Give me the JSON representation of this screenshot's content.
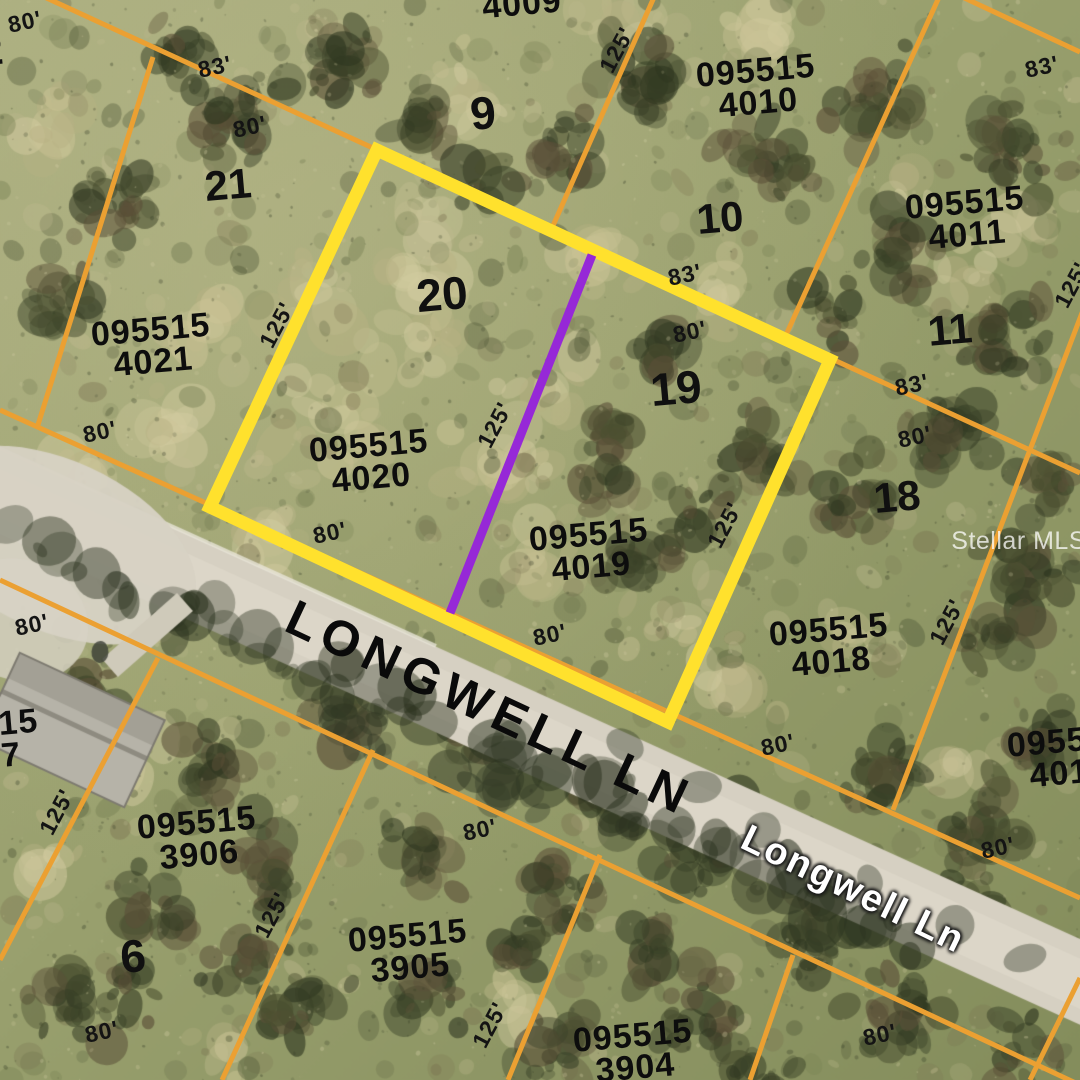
{
  "watermark": "Stellar MLS",
  "colors": {
    "highlight_yellow": "#FFE12D",
    "boundary_orange": "#EBA032",
    "division_purple": "#9628D7"
  },
  "roads": [
    {
      "name": "LONGWELL LN",
      "x": 490,
      "y": 708,
      "rotate": 25,
      "style": "road-black"
    },
    {
      "name": "Longwell Ln",
      "x": 853,
      "y": 890,
      "rotate": 26,
      "style": "road-white"
    }
  ],
  "highlighted_parcel": {
    "corners": [
      [
        377,
        150
      ],
      [
        830,
        360
      ],
      [
        668,
        722
      ],
      [
        210,
        507
      ]
    ],
    "stroke_width": 13,
    "division_line": {
      "x1": 592,
      "y1": 255,
      "x2": 450,
      "y2": 613,
      "width": 9
    }
  },
  "parcels": [
    {
      "line1": "4009",
      "line2": "",
      "x": 522,
      "y": 4
    },
    {
      "line1": "095515",
      "line2": "4010",
      "x": 757,
      "y": 87
    },
    {
      "line1": "095515",
      "line2": "4011",
      "x": 966,
      "y": 219
    },
    {
      "line1": "095515",
      "line2": "4021",
      "x": 152,
      "y": 346
    },
    {
      "line1": "095515",
      "line2": "4020",
      "x": 370,
      "y": 462
    },
    {
      "line1": "095515",
      "line2": "4019",
      "x": 590,
      "y": 551
    },
    {
      "line1": "095515",
      "line2": "4018",
      "x": 830,
      "y": 646
    },
    {
      "line1": "095515",
      "line2": "4017",
      "x": 1068,
      "y": 757
    },
    {
      "line1": "095515",
      "line2": "3907",
      "x": -20,
      "y": 742
    },
    {
      "line1": "095515",
      "line2": "3906",
      "x": 198,
      "y": 839
    },
    {
      "line1": "095515",
      "line2": "3905",
      "x": 409,
      "y": 952
    },
    {
      "line1": "095515",
      "line2": "3904",
      "x": 634,
      "y": 1052
    }
  ],
  "lot_numbers": [
    {
      "text": "9",
      "x": 483,
      "y": 113,
      "size": 46
    },
    {
      "text": "10",
      "x": 720,
      "y": 218,
      "size": 42
    },
    {
      "text": "11",
      "x": 950,
      "y": 330,
      "size": 42
    },
    {
      "text": "21",
      "x": 228,
      "y": 185,
      "size": 42
    },
    {
      "text": "20",
      "x": 442,
      "y": 294,
      "size": 46
    },
    {
      "text": "19",
      "x": 676,
      "y": 388,
      "size": 46
    },
    {
      "text": "18",
      "x": 897,
      "y": 497,
      "size": 42
    },
    {
      "text": "6",
      "x": 133,
      "y": 956,
      "size": 46
    },
    {
      "text": "2",
      "x": -8,
      "y": 52,
      "size": 40
    }
  ],
  "dimensions": [
    {
      "text": "80'",
      "x": 25,
      "y": 22,
      "rotate": -12
    },
    {
      "text": "83'",
      "x": 215,
      "y": 67,
      "rotate": -12
    },
    {
      "text": "80'",
      "x": 250,
      "y": 127,
      "rotate": -12
    },
    {
      "text": "125'",
      "x": 617,
      "y": 50,
      "rotate": -62
    },
    {
      "text": "83'",
      "x": 1042,
      "y": 67,
      "rotate": -12
    },
    {
      "text": "83'",
      "x": 685,
      "y": 275,
      "rotate": -12
    },
    {
      "text": "80'",
      "x": 690,
      "y": 332,
      "rotate": -12
    },
    {
      "text": "125'",
      "x": 1072,
      "y": 285,
      "rotate": -62
    },
    {
      "text": "125'",
      "x": 277,
      "y": 325,
      "rotate": -62
    },
    {
      "text": "83'",
      "x": 912,
      "y": 385,
      "rotate": -12
    },
    {
      "text": "80'",
      "x": 915,
      "y": 437,
      "rotate": -12
    },
    {
      "text": "125'",
      "x": 495,
      "y": 425,
      "rotate": -62
    },
    {
      "text": "80'",
      "x": 100,
      "y": 432,
      "rotate": -12
    },
    {
      "text": "125'",
      "x": 725,
      "y": 525,
      "rotate": -62
    },
    {
      "text": "80'",
      "x": 330,
      "y": 533,
      "rotate": -12
    },
    {
      "text": "125'",
      "x": 947,
      "y": 622,
      "rotate": -62
    },
    {
      "text": "80'",
      "x": 550,
      "y": 635,
      "rotate": -12
    },
    {
      "text": "80'",
      "x": 32,
      "y": 625,
      "rotate": -12
    },
    {
      "text": "80'",
      "x": 778,
      "y": 745,
      "rotate": -12
    },
    {
      "text": "125'",
      "x": 57,
      "y": 812,
      "rotate": -62
    },
    {
      "text": "80'",
      "x": 480,
      "y": 830,
      "rotate": -12
    },
    {
      "text": "80'",
      "x": 998,
      "y": 848,
      "rotate": -12
    },
    {
      "text": "125'",
      "x": 272,
      "y": 915,
      "rotate": -62
    },
    {
      "text": "125'",
      "x": 490,
      "y": 1025,
      "rotate": -62
    },
    {
      "text": "80'",
      "x": 102,
      "y": 1032,
      "rotate": -12
    },
    {
      "text": "80'",
      "x": 880,
      "y": 1035,
      "rotate": -12
    }
  ],
  "boundary_lines": [
    {
      "x1": 40,
      "y1": -5,
      "x2": 1080,
      "y2": 473
    },
    {
      "x1": 153,
      "y1": 57,
      "x2": 37,
      "y2": 428
    },
    {
      "x1": 655,
      "y1": -5,
      "x2": 552,
      "y2": 228
    },
    {
      "x1": 940,
      "y1": -5,
      "x2": 786,
      "y2": 335
    },
    {
      "x1": 958,
      "y1": -5,
      "x2": 1080,
      "y2": 52
    },
    {
      "x1": 1085,
      "y1": 305,
      "x2": 893,
      "y2": 810
    },
    {
      "x1": 0,
      "y1": 410,
      "x2": 1080,
      "y2": 898
    },
    {
      "x1": 0,
      "y1": 580,
      "x2": 1080,
      "y2": 1085
    },
    {
      "x1": 158,
      "y1": 658,
      "x2": 0,
      "y2": 960
    },
    {
      "x1": 373,
      "y1": 750,
      "x2": 222,
      "y2": 1080
    },
    {
      "x1": 600,
      "y1": 855,
      "x2": 508,
      "y2": 1080
    },
    {
      "x1": 793,
      "y1": 955,
      "x2": 750,
      "y2": 1080
    },
    {
      "x1": 1080,
      "y1": 978,
      "x2": 1030,
      "y2": 1080
    }
  ]
}
